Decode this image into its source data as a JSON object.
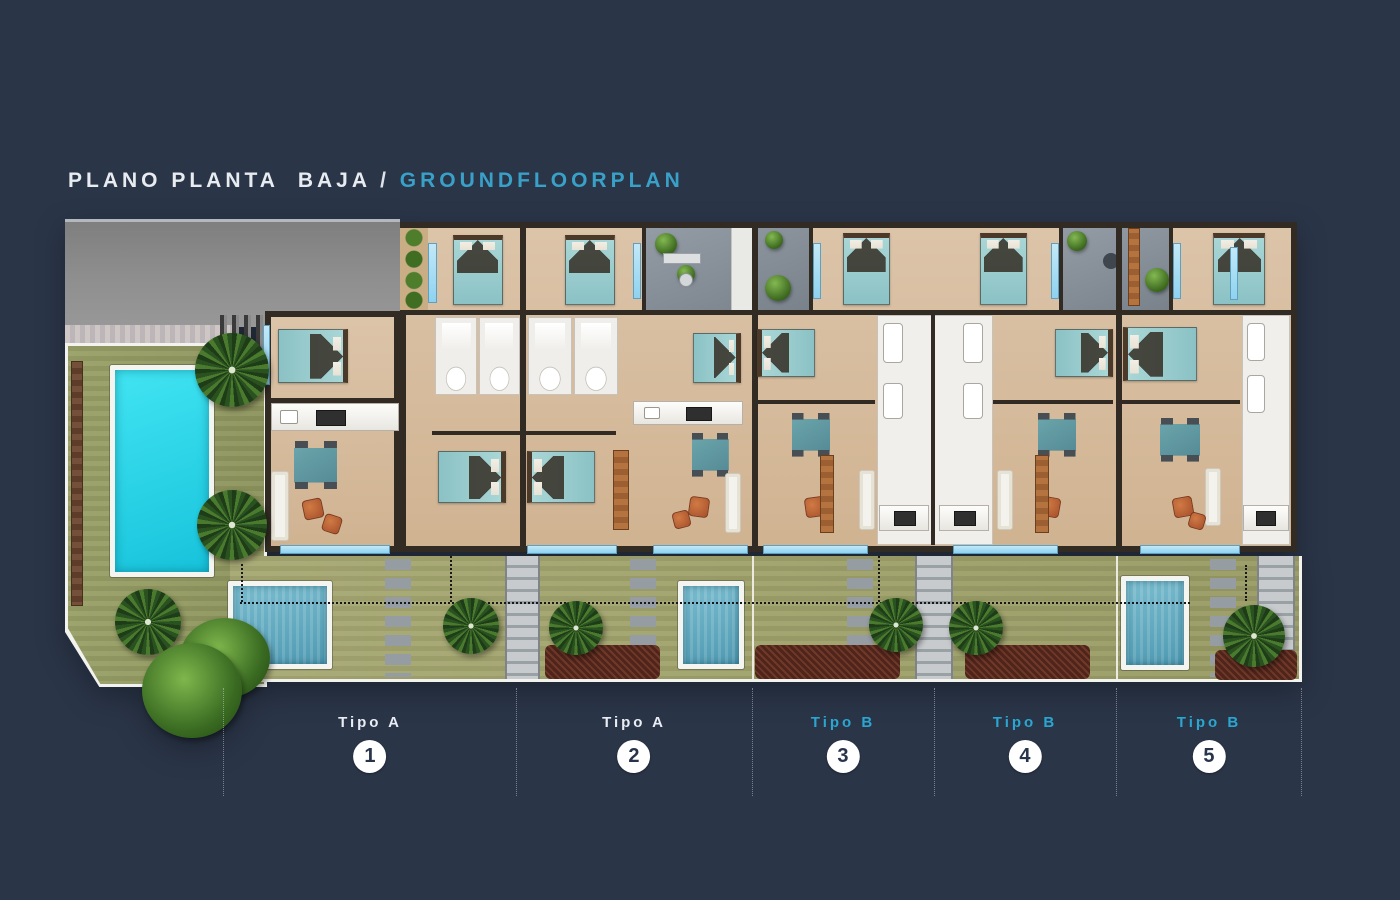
{
  "title": {
    "primary": "PLANO PLANTA  BAJA",
    "separator": " / ",
    "secondary": "GROUNDFLOORPLAN"
  },
  "units": [
    {
      "type_label": "Tipo A",
      "number": "1"
    },
    {
      "type_label": "Tipo A",
      "number": "2"
    },
    {
      "type_label": "Tipo B",
      "number": "3"
    },
    {
      "type_label": "Tipo B",
      "number": "4"
    },
    {
      "type_label": "Tipo B",
      "number": "5"
    }
  ],
  "colors": {
    "background": "#2a3548",
    "accent_cyan": "#39a0c8",
    "label_type_a": "#e9edf3",
    "label_type_b": "#2ba6d1",
    "badge_background": "#ffffff",
    "badge_number": "#27344a",
    "communal_pool_water": "#27d7ea",
    "private_pool_water": "#5fa8c0",
    "floor_beige": "#d7bda0",
    "wall_dark": "#322b23",
    "lawn_green": "#9ea26b",
    "patio_grey": "#8a939c",
    "glazing_blue": "#8ed2f0"
  }
}
